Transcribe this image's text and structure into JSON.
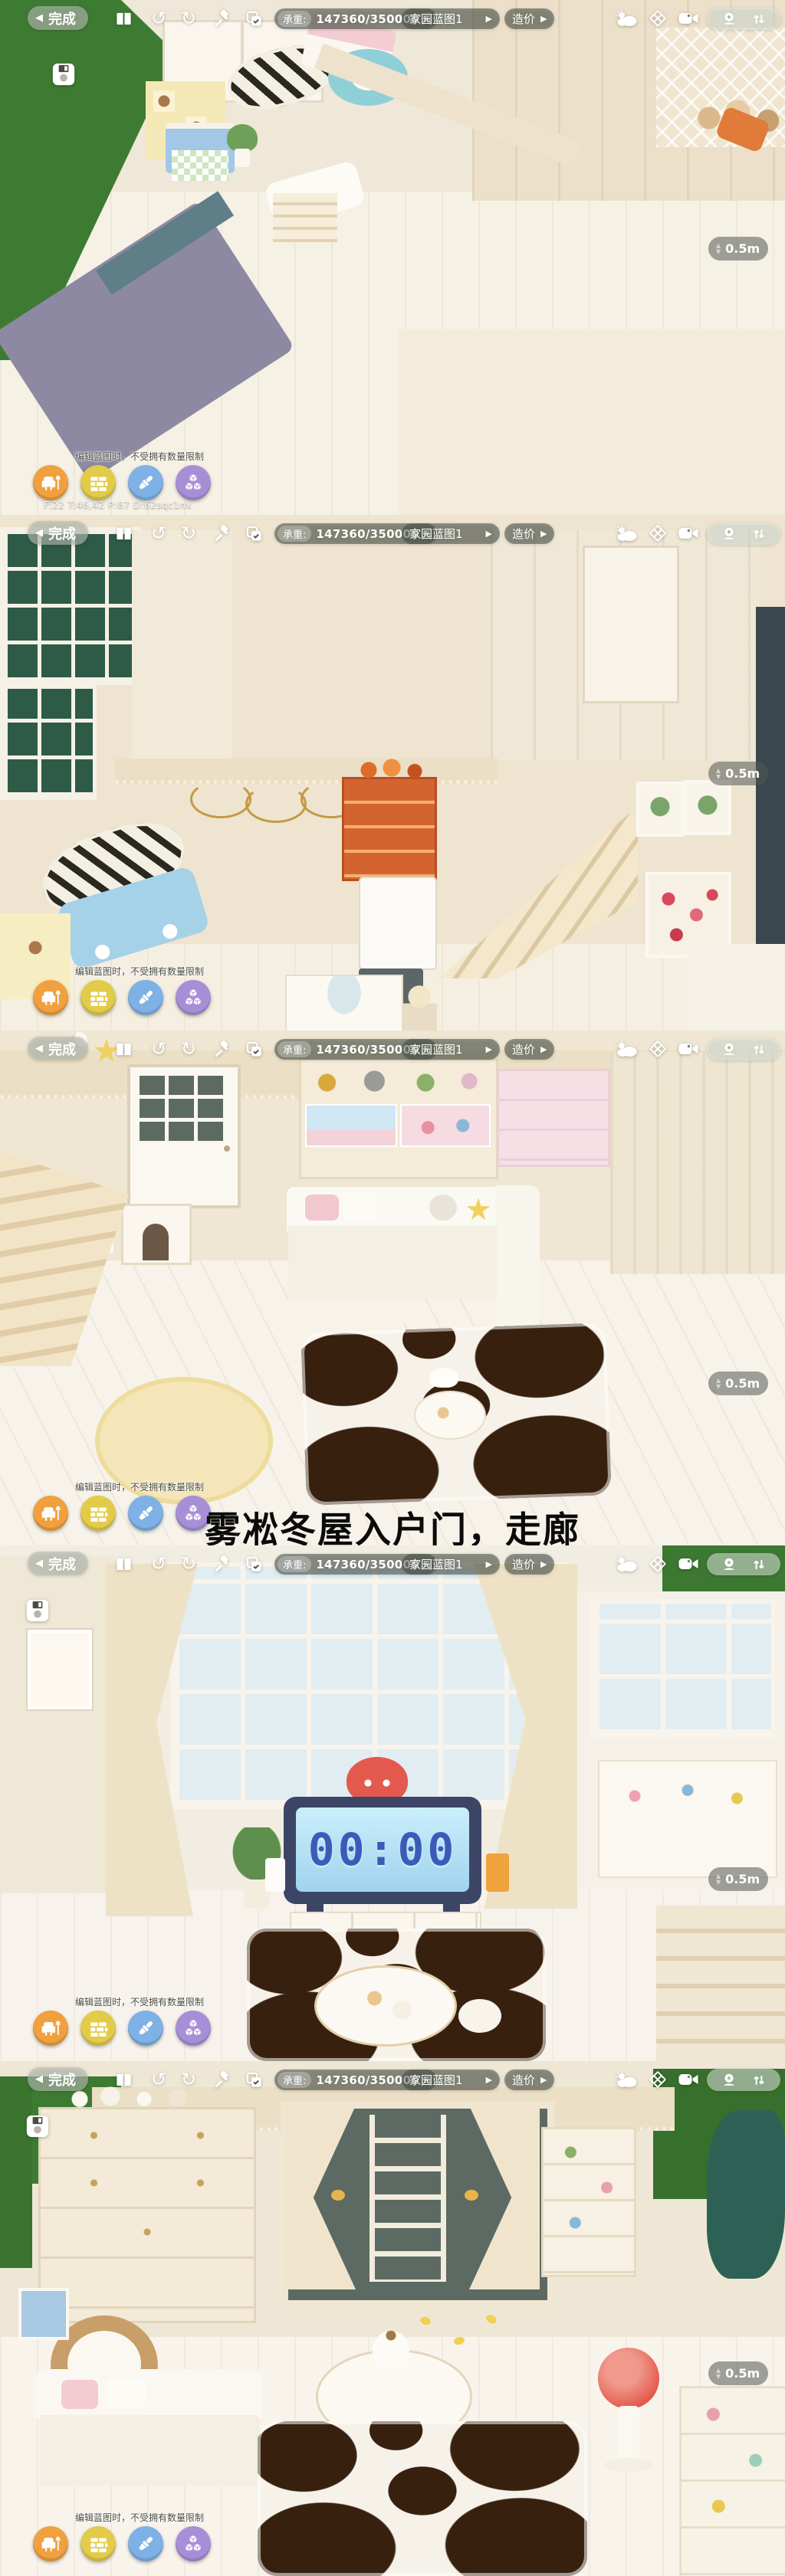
{
  "app": {
    "type": "home-design-game-screenshot-strip",
    "panels": 5
  },
  "hud": {
    "back_button": {
      "chevron": "◀",
      "label": "完成"
    },
    "toolbar_icons": [
      "blueprint-book",
      "undo",
      "redo",
      "hammer",
      "copy-check"
    ],
    "weight": {
      "label": "承重:",
      "value": "147360/350000",
      "arrow": "▶"
    },
    "blueprint": {
      "label": "家园蓝图1",
      "arrow": "▶"
    },
    "cost": {
      "label": "造价",
      "arrow": "▶"
    },
    "view_icons": [
      "weather-cloud",
      "floor-grid",
      "video-camera"
    ],
    "camera_pill_icons": [
      "observer-camera",
      "sort-arrows"
    ],
    "save_icon": "floppy-disk",
    "grid_size": {
      "up": "▲",
      "down": "▼",
      "value": "0.5m"
    },
    "hint": "编辑蓝图时，不受拥有数量限制",
    "debug_overlay": "F:22  T:46,42  P:87  D:62sqc1nx",
    "modes": [
      {
        "id": "furniture",
        "icon": "armchair-lamp",
        "color": "#F0A03E"
      },
      {
        "id": "wall",
        "icon": "bricks",
        "color": "#E2CB49"
      },
      {
        "id": "paint",
        "icon": "paint-brush",
        "color": "#7EB1E6"
      },
      {
        "id": "blocks",
        "icon": "cubes",
        "color": "#A78FD8"
      }
    ]
  },
  "caption": "雾凇冬屋入户门，走廊",
  "scene": {
    "clock_time": "00:00"
  },
  "colors": {
    "hud_pill": "rgba(62,70,62,0.52)",
    "grass": "#3E7B32",
    "cream_wall": "#EFE6D4",
    "floor_white": "#F7F3EA",
    "cow_patch": "#38200F",
    "clock_frame": "#3D4566",
    "clock_screen": "#A9DCF2",
    "clock_digits": "#3A5CB8"
  }
}
